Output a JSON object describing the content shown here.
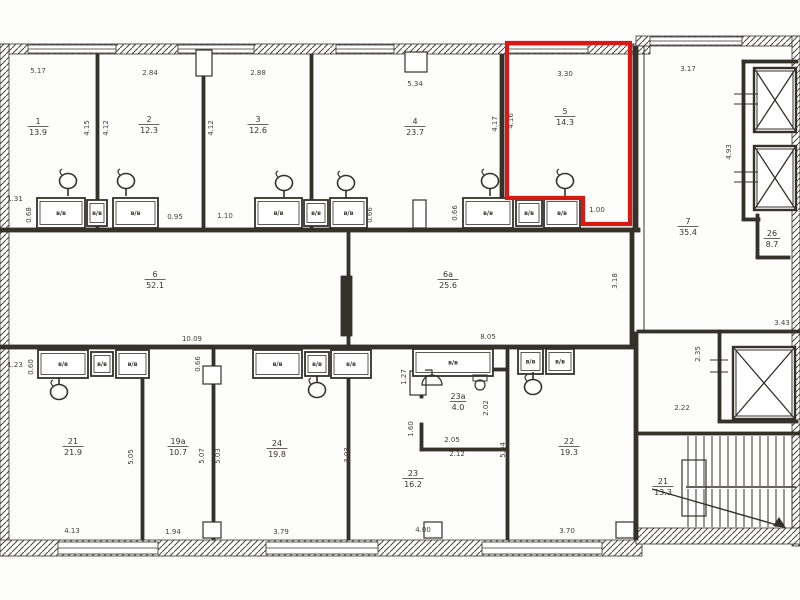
{
  "plan": {
    "ink": "#34302a",
    "paper": "#fdfdfb",
    "highlight_color": "#d41a12",
    "box_label": "в/в",
    "rooms": [
      {
        "id": "room-1",
        "number": "1",
        "area": "13.9",
        "x": 38,
        "y": 124
      },
      {
        "id": "room-2",
        "number": "2",
        "area": "12.3",
        "x": 149,
        "y": 122
      },
      {
        "id": "room-3",
        "number": "3",
        "area": "12.6",
        "x": 258,
        "y": 122
      },
      {
        "id": "room-4",
        "number": "4",
        "area": "23.7",
        "x": 415,
        "y": 124
      },
      {
        "id": "room-5",
        "number": "5",
        "area": "14.3",
        "x": 565,
        "y": 114,
        "hl": true
      },
      {
        "id": "room-6",
        "number": "6",
        "area": "52.1",
        "x": 155,
        "y": 277
      },
      {
        "id": "room-6a",
        "number": "6а",
        "area": "25.6",
        "x": 448,
        "y": 277
      },
      {
        "id": "room-7",
        "number": "7",
        "area": "35.4",
        "x": 688,
        "y": 224
      },
      {
        "id": "room-26",
        "number": "26",
        "area": "8.7",
        "x": 772,
        "y": 236
      },
      {
        "id": "room-21",
        "number": "21",
        "area": "21.9",
        "x": 73,
        "y": 444
      },
      {
        "id": "room-19a",
        "number": "19а",
        "area": "10.7",
        "x": 178,
        "y": 444
      },
      {
        "id": "room-24",
        "number": "24",
        "area": "19.8",
        "x": 277,
        "y": 446
      },
      {
        "id": "room-23",
        "number": "23",
        "area": "16.2",
        "x": 413,
        "y": 476
      },
      {
        "id": "room-23a",
        "number": "23а",
        "area": "4.0",
        "x": 458,
        "y": 399
      },
      {
        "id": "room-22",
        "number": "22",
        "area": "19.3",
        "x": 569,
        "y": 444
      },
      {
        "id": "stair-21",
        "number": "21",
        "area": "13.3",
        "x": 663,
        "y": 484
      }
    ],
    "dims": [
      {
        "v": "5.17",
        "x": 38,
        "y": 73
      },
      {
        "v": "2.84",
        "x": 150,
        "y": 75
      },
      {
        "v": "2.88",
        "x": 258,
        "y": 75
      },
      {
        "v": "5.34",
        "x": 415,
        "y": 86
      },
      {
        "v": "3.30",
        "x": 565,
        "y": 76
      },
      {
        "v": "3.17",
        "x": 688,
        "y": 71
      },
      {
        "v": "4.15",
        "x": 89,
        "y": 128,
        "r": 1
      },
      {
        "v": "4.12",
        "x": 108,
        "y": 128,
        "r": 1
      },
      {
        "v": "4.12",
        "x": 213,
        "y": 128,
        "r": 1
      },
      {
        "v": "4.17",
        "x": 497,
        "y": 124,
        "r": 1
      },
      {
        "v": "4.16",
        "x": 513,
        "y": 121,
        "r": 1
      },
      {
        "v": "4.93",
        "x": 731,
        "y": 152,
        "r": 1
      },
      {
        "v": "1.31",
        "x": 15,
        "y": 201
      },
      {
        "v": "0.68",
        "x": 31,
        "y": 215,
        "r": 1
      },
      {
        "v": "0.95",
        "x": 175,
        "y": 219
      },
      {
        "v": "1.10",
        "x": 225,
        "y": 218
      },
      {
        "v": "0.66",
        "x": 372,
        "y": 215,
        "r": 1
      },
      {
        "v": "0.66",
        "x": 457,
        "y": 213,
        "r": 1
      },
      {
        "v": "1.00",
        "x": 597,
        "y": 212
      },
      {
        "v": "3.18",
        "x": 617,
        "y": 281,
        "r": 1
      },
      {
        "v": "10.09",
        "x": 192,
        "y": 341
      },
      {
        "v": "1.23",
        "x": 15,
        "y": 367
      },
      {
        "v": "0.60",
        "x": 33,
        "y": 367,
        "r": 1
      },
      {
        "v": "0.66",
        "x": 200,
        "y": 364,
        "r": 1
      },
      {
        "v": "8.05",
        "x": 488,
        "y": 339
      },
      {
        "v": "1.27",
        "x": 406,
        "y": 377,
        "r": 1
      },
      {
        "v": "5.05",
        "x": 133,
        "y": 457,
        "r": 1
      },
      {
        "v": "5.07",
        "x": 204,
        "y": 456,
        "r": 1
      },
      {
        "v": "5.03",
        "x": 220,
        "y": 456,
        "r": 1
      },
      {
        "v": "3.03",
        "x": 349,
        "y": 455,
        "r": 1
      },
      {
        "v": "1.60",
        "x": 413,
        "y": 429,
        "r": 1
      },
      {
        "v": "2.05",
        "x": 452,
        "y": 442
      },
      {
        "v": "2.12",
        "x": 457,
        "y": 456
      },
      {
        "v": "2.02",
        "x": 488,
        "y": 408,
        "r": 1
      },
      {
        "v": "5.04",
        "x": 505,
        "y": 450,
        "r": 1
      },
      {
        "v": "2.22",
        "x": 682,
        "y": 410
      },
      {
        "v": "2.35",
        "x": 700,
        "y": 354,
        "r": 1
      },
      {
        "v": "3.43",
        "x": 782,
        "y": 325
      },
      {
        "v": "4.13",
        "x": 72,
        "y": 533
      },
      {
        "v": "1.94",
        "x": 173,
        "y": 534
      },
      {
        "v": "3.79",
        "x": 281,
        "y": 534
      },
      {
        "v": "4.00",
        "x": 423,
        "y": 532
      },
      {
        "v": "3.70",
        "x": 567,
        "y": 533
      }
    ],
    "walls_ext": [
      [
        0,
        44,
        650,
        10
      ],
      [
        636,
        36,
        164,
        10
      ],
      [
        0,
        44,
        9,
        512
      ],
      [
        792,
        36,
        8,
        510
      ],
      [
        0,
        540,
        642,
        16
      ],
      [
        636,
        528,
        164,
        16
      ]
    ],
    "windows": [
      [
        28,
        45,
        88,
        8
      ],
      [
        178,
        45,
        76,
        8
      ],
      [
        336,
        45,
        58,
        8
      ],
      [
        508,
        45,
        80,
        8
      ],
      [
        650,
        37,
        92,
        8
      ],
      [
        58,
        542,
        100,
        12
      ],
      [
        266,
        542,
        112,
        12
      ],
      [
        482,
        542,
        120,
        12
      ]
    ],
    "walls_int": [
      [
        96,
        54,
        3,
        174
      ],
      [
        202,
        54,
        3,
        174
      ],
      [
        310,
        54,
        3,
        174
      ],
      [
        500,
        54,
        4,
        174
      ],
      [
        633,
        46,
        5,
        184
      ],
      [
        0,
        228,
        640,
        4
      ],
      [
        0,
        345,
        634,
        4
      ],
      [
        347,
        232,
        3,
        113
      ],
      [
        630,
        232,
        4,
        113
      ],
      [
        141,
        349,
        3,
        191
      ],
      [
        212,
        349,
        3,
        191
      ],
      [
        347,
        349,
        3,
        191
      ],
      [
        506,
        349,
        3,
        191
      ],
      [
        634,
        332,
        4,
        208
      ],
      [
        420,
        368,
        88,
        3
      ],
      [
        420,
        448,
        88,
        3
      ],
      [
        420,
        368,
        3,
        30
      ],
      [
        420,
        423,
        3,
        28
      ],
      [
        637,
        330,
        163,
        3
      ],
      [
        718,
        330,
        3,
        92
      ],
      [
        718,
        420,
        80,
        3
      ],
      [
        742,
        60,
        3,
        160
      ],
      [
        742,
        60,
        56,
        3
      ],
      [
        742,
        218,
        18,
        3
      ],
      [
        756,
        214,
        3,
        44
      ],
      [
        756,
        256,
        34,
        3
      ],
      [
        636,
        432,
        164,
        3
      ]
    ],
    "solids": [
      [
        341,
        276,
        11,
        60
      ]
    ],
    "slots": [
      [
        196,
        50,
        16,
        26
      ],
      [
        405,
        52,
        22,
        20
      ],
      [
        413,
        200,
        13,
        28
      ],
      [
        410,
        371,
        16,
        24
      ],
      [
        203,
        366,
        18,
        18
      ],
      [
        203,
        522,
        18,
        16
      ],
      [
        424,
        522,
        18,
        16
      ],
      [
        616,
        522,
        18,
        16
      ],
      [
        682,
        460,
        24,
        56
      ]
    ],
    "boxes": [
      [
        37,
        198,
        48,
        30
      ],
      [
        87,
        200,
        20,
        26
      ],
      [
        113,
        198,
        45,
        30
      ],
      [
        255,
        198,
        47,
        30
      ],
      [
        304,
        200,
        24,
        26
      ],
      [
        330,
        198,
        37,
        30
      ],
      [
        463,
        198,
        50,
        30
      ],
      [
        516,
        200,
        26,
        26
      ],
      [
        544,
        198,
        36,
        30
      ],
      [
        38,
        350,
        50,
        28
      ],
      [
        91,
        352,
        22,
        24
      ],
      [
        116,
        350,
        33,
        28
      ],
      [
        253,
        350,
        49,
        28
      ],
      [
        305,
        352,
        24,
        24
      ],
      [
        331,
        350,
        40,
        28
      ],
      [
        413,
        349,
        80,
        27
      ],
      [
        518,
        349,
        25,
        25
      ],
      [
        546,
        349,
        28,
        25
      ]
    ],
    "sinks": [
      [
        68,
        181,
        1
      ],
      [
        126,
        181,
        1
      ],
      [
        284,
        183,
        1
      ],
      [
        346,
        183,
        1
      ],
      [
        490,
        181,
        1
      ],
      [
        565,
        181,
        1
      ],
      [
        59,
        392,
        -1
      ],
      [
        317,
        390,
        -1
      ],
      [
        533,
        387,
        -1
      ]
    ],
    "elevators": [
      [
        754,
        68,
        42,
        64
      ],
      [
        754,
        146,
        42,
        64
      ],
      [
        733,
        347,
        62,
        72
      ]
    ],
    "lines": [
      [
        734,
        94,
        758,
        94,
        1
      ],
      [
        734,
        104,
        758,
        104,
        1
      ],
      [
        734,
        172,
        758,
        172,
        1
      ],
      [
        734,
        182,
        758,
        182,
        1
      ],
      [
        710,
        360,
        728,
        360,
        1
      ],
      [
        710,
        372,
        728,
        372,
        1
      ],
      [
        644,
        46,
        644,
        330,
        1
      ],
      [
        686,
        487,
        796,
        487,
        1.4
      ],
      [
        652,
        489,
        784,
        527,
        1.4
      ]
    ],
    "stairs": {
      "x0": 688,
      "x1": 794,
      "step": 8,
      "top": 436,
      "mid": 487,
      "bot": 527,
      "arrow": "786,528 773,526 779,517"
    },
    "toilet": {
      "cx": 480,
      "cy": 385
    },
    "shower": {
      "cx": 432,
      "cy": 385
    },
    "highlight_path": "M507,43 L630,43 L630,224 L583,224 L583,198 L507,198 Z"
  }
}
